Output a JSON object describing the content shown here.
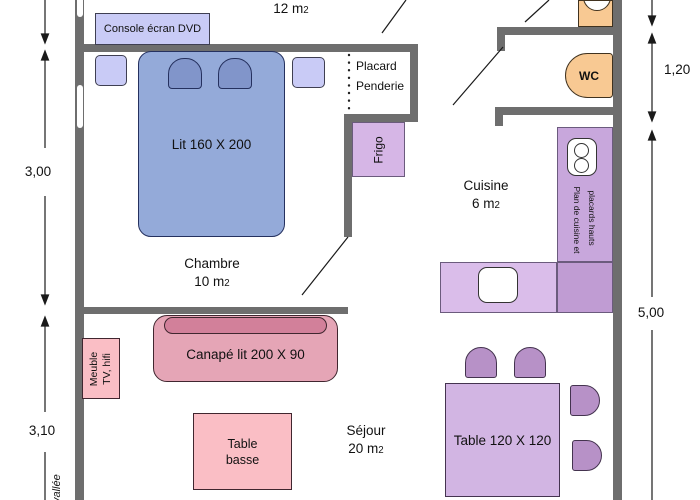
{
  "colors": {
    "wall": "#6e6e6e",
    "bed_blue": "#94aad9",
    "lavender": "#c9cbf6",
    "fridge_lilac": "#d6b6e6",
    "counter_purple": "#c8a7dc",
    "table_purple": "#d2b5e3",
    "chair_purple": "#b791c7",
    "fixture_orange": "#f8c993",
    "sofa_pink": "#e5a5b6",
    "light_pink": "#fabec5"
  },
  "labels": {
    "top_area": {
      "value": "12 m",
      "sub": "2"
    },
    "console": "Console écran DVD",
    "placard_line1": "Placard",
    "placard_line2": "Penderie",
    "frigo": "Frigo",
    "bed": "Lit 160 X 200",
    "wc": "WC",
    "chambre": {
      "name": "Chambre",
      "area": "10 m",
      "area_sub": "2"
    },
    "cuisine": {
      "name": "Cuisine",
      "area": "6 m",
      "area_sub": "2"
    },
    "sejour": {
      "name": "Séjour",
      "area": "20 m",
      "area_sub": "2"
    },
    "kitchen_plan_col1": "Plan de cuisine et",
    "kitchen_plan_col2": "placards hauts",
    "sofa": "Canapé lit 200 X 90",
    "tv_unit_line1": "Meuble",
    "tv_unit_line2": "TV, hifi",
    "coffee_table_line1": "Table",
    "coffee_table_line2": "basse",
    "dining_table": "Table 120 X 120",
    "valley": "vallée"
  },
  "dimensions": {
    "left_upper": "3,00",
    "left_lower": "3,10",
    "right_upper": "1,20",
    "right_lower": "5,00"
  }
}
